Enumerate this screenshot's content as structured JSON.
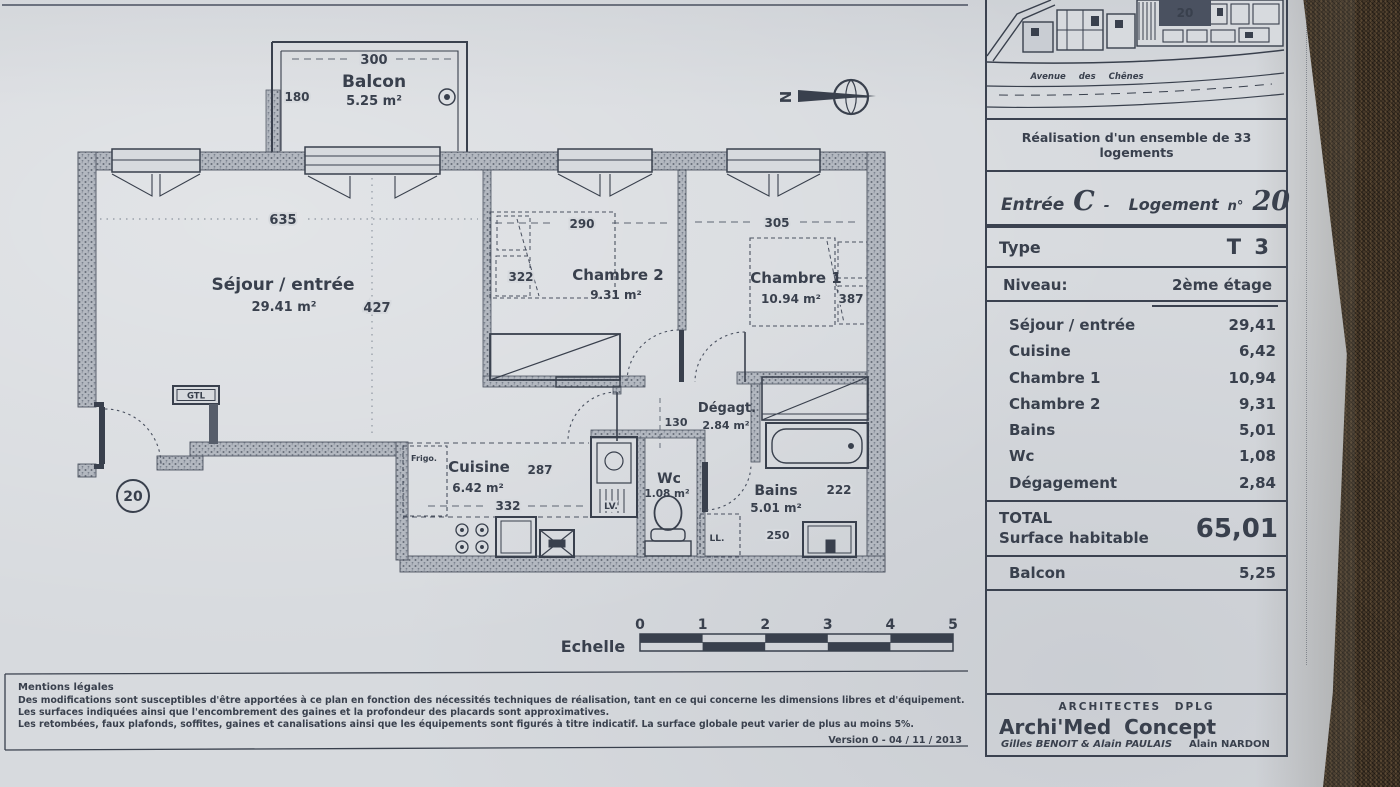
{
  "colors": {
    "ink": "#39404d",
    "paper": "#d7dade",
    "wall_gray": "#b3b8c0",
    "fabric": "#47392a"
  },
  "site_map": {
    "street": "Avenue des Chênes",
    "marker": "20"
  },
  "title_block": {
    "project": "Réalisation d'un ensemble de 33 logements",
    "entree_label": "Entrée",
    "entree_value": "C",
    "sep": "-",
    "logement_label": "Logement",
    "num_label": "n°",
    "logement_value": "20",
    "type_label": "Type",
    "type_value": "T 3",
    "niveau_label": "Niveau:",
    "niveau_value": "2ème étage",
    "rooms": [
      {
        "name": "Séjour / entrée",
        "area": "29,41"
      },
      {
        "name": "Cuisine",
        "area": "6,42"
      },
      {
        "name": "Chambre 1",
        "area": "10,94"
      },
      {
        "name": "Chambre 2",
        "area": "9,31"
      },
      {
        "name": "Bains",
        "area": "5,01"
      },
      {
        "name": "Wc",
        "area": "1,08"
      },
      {
        "name": "Dégagement",
        "area": "2,84"
      }
    ],
    "total_label": "TOTAL",
    "total_sublabel": "Surface habitable",
    "total_value": "65,01",
    "balcon_label": "Balcon",
    "balcon_value": "5,25"
  },
  "architects": {
    "heading": "ARCHITECTES DPLG",
    "firm": "Archi'Med Concept",
    "team1": "Gilles BENOIT & Alain PAULAIS",
    "team2": "Alain NARDON"
  },
  "plan": {
    "balcon": {
      "name": "Balcon",
      "area": "5.25 m²",
      "dim_w": "300",
      "dim_h": "180"
    },
    "sejour": {
      "name": "Séjour / entrée",
      "area": "29.41 m²",
      "dim_w": "635",
      "dim_h": "427"
    },
    "chambre2": {
      "name": "Chambre 2",
      "area": "9.31 m²",
      "dim_w": "290",
      "dim_h": "322"
    },
    "chambre1": {
      "name": "Chambre 1",
      "area": "10.94 m²",
      "dim_w": "305",
      "dim_h": "387"
    },
    "degagt": {
      "name": "Dégagt.",
      "area": "2.84 m²",
      "dim": "130"
    },
    "cuisine": {
      "name": "Cuisine",
      "area": "6.42 m²",
      "dim_w": "287",
      "dim_h": "332"
    },
    "wc": {
      "name": "Wc",
      "area": "1.08 m²"
    },
    "bains": {
      "name": "Bains",
      "area": "5.01 m²",
      "dim_w": "222",
      "dim_h": "250"
    },
    "gtl": "GTL",
    "frigo": "Frigo.",
    "lv": "LV.",
    "ll": "LL.",
    "north": "N",
    "unit_number": "20"
  },
  "scale_bar": {
    "label": "Echelle",
    "ticks": [
      "0",
      "1",
      "2",
      "3",
      "4",
      "5"
    ]
  },
  "legal": {
    "title": "Mentions légales",
    "line1": "Des modifications sont susceptibles d'être apportées à ce plan en fonction des nécessités techniques de réalisation, tant en ce qui concerne les dimensions libres et d'équipement.",
    "line2": "Les surfaces indiquées ainsi que l'encombrement des gaines et la profondeur des placards sont approximatives.",
    "line3": "Les retombées, faux plafonds, soffites, gaines et canalisations ainsi que les équipements sont figurés à titre indicatif. La surface globale peut varier de plus au moins 5%.",
    "version": "Version 0 - 04 / 11 / 2013"
  }
}
